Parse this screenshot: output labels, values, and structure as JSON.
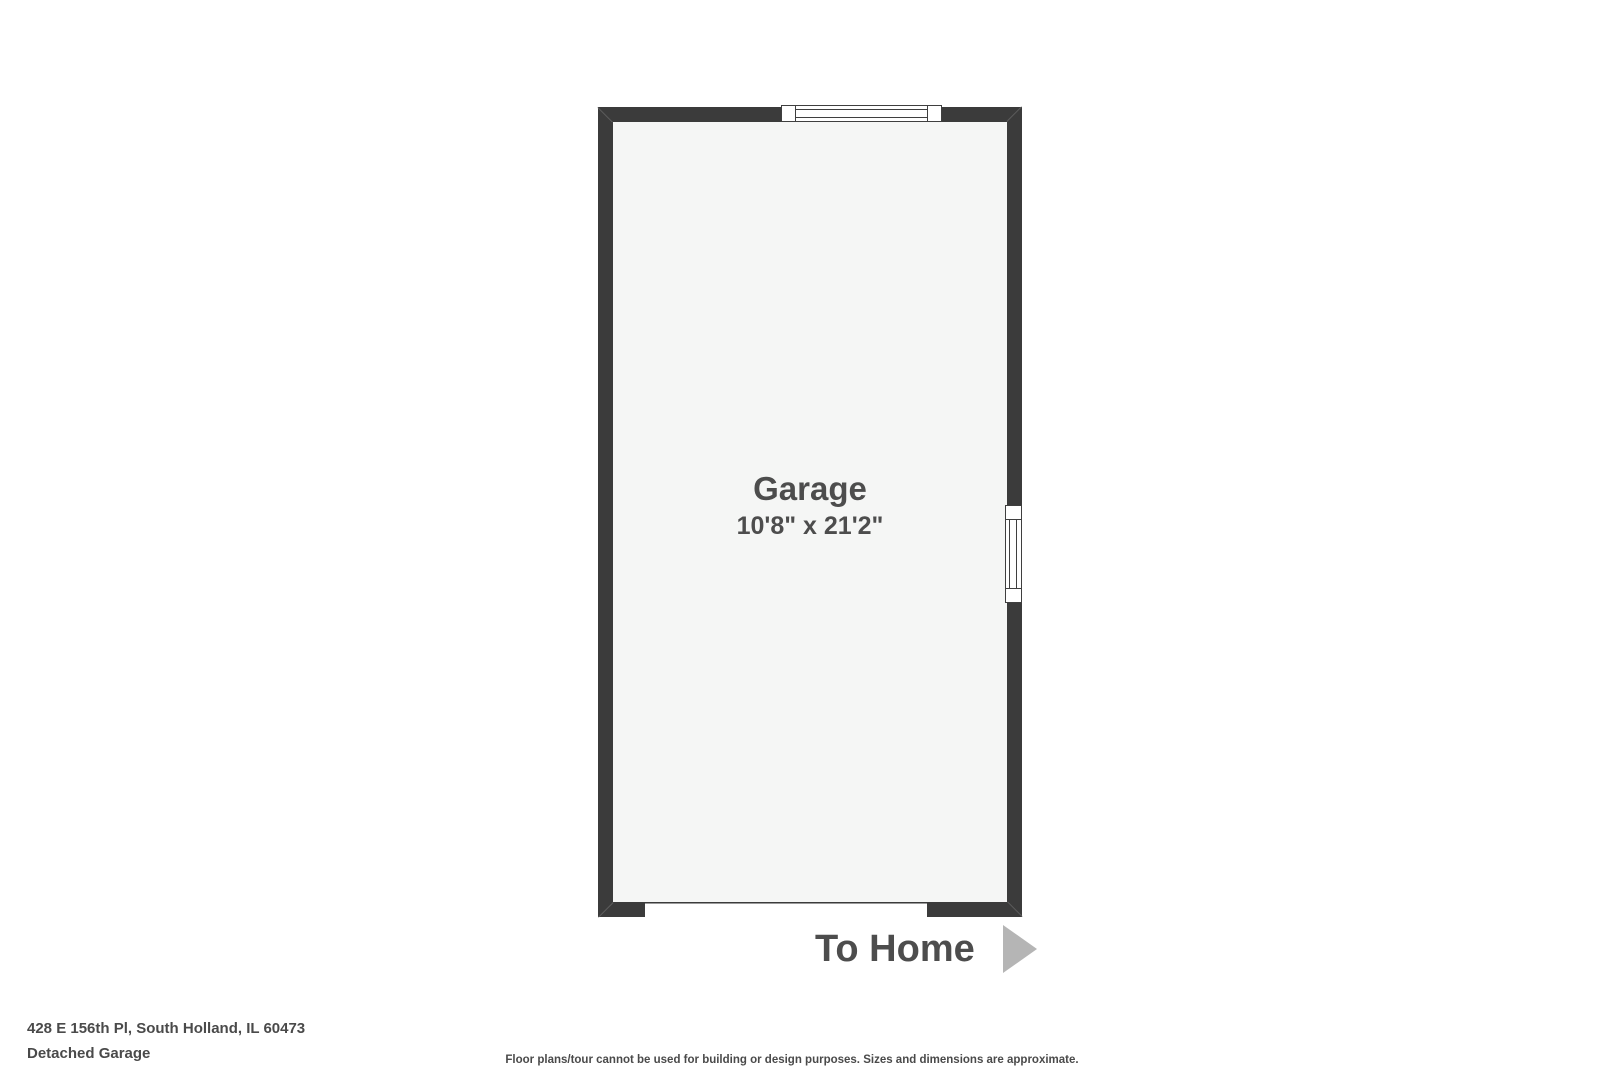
{
  "plan": {
    "room_name": "Garage",
    "room_dimensions": "10'8\" x 21'2\"",
    "to_home_label": "To Home"
  },
  "footer": {
    "address": "428 E 156th Pl, South Holland, IL 60473",
    "subtitle": "Detached Garage",
    "disclaimer": "Floor plans/tour cannot be used for building or design purposes. Sizes and dimensions are approximate."
  },
  "icons": {
    "to_home_arrow_icon": "right-pointing-triangle"
  },
  "colors": {
    "wall": "#3b3b3b",
    "room_fill": "#f5f6f5",
    "label_text": "#4d4d4d",
    "footer_text": "#4a4a4a",
    "arrow": "#b5b5b5",
    "background": "#ffffff"
  }
}
